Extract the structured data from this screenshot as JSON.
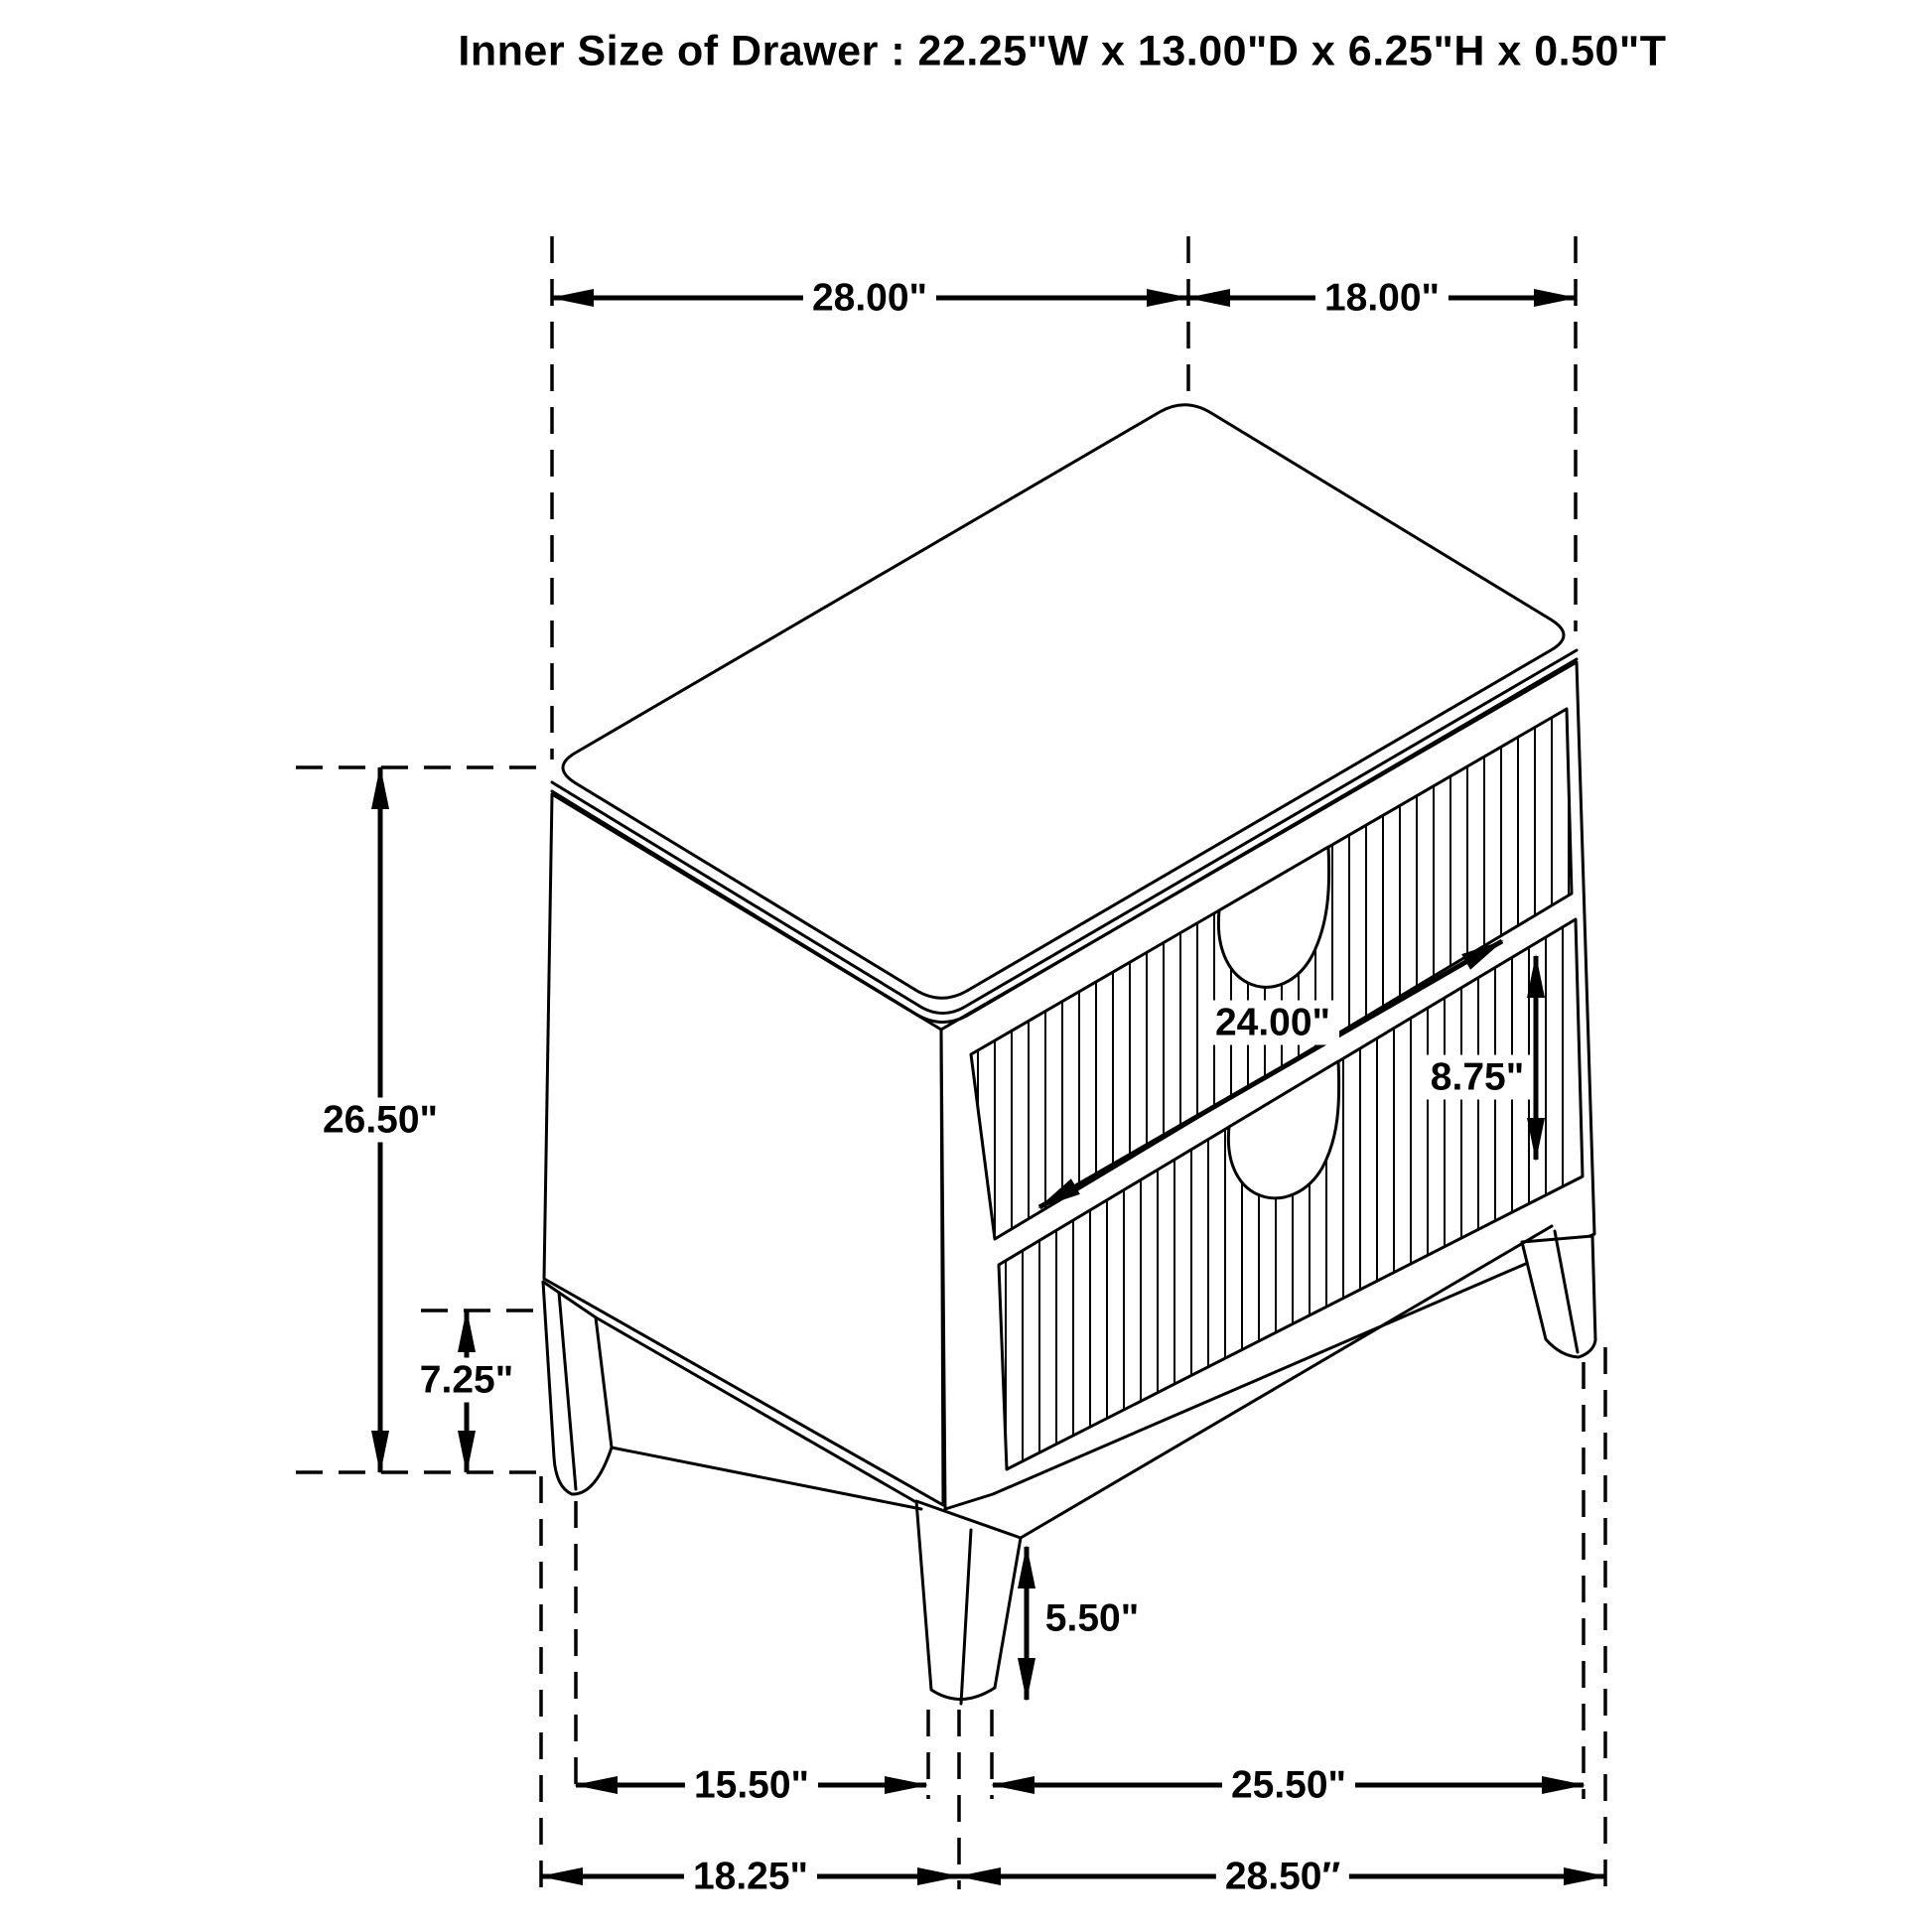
{
  "title": "Inner Size of Drawer : 22.25\"W x 13.00\"D x 6.25\"H x 0.50\"T",
  "dims": {
    "top_width": "28.00\"",
    "top_depth": "18.00\"",
    "overall_height": "26.50\"",
    "back_leg_height": "7.25\"",
    "drawer_front_width": "24.00\"",
    "drawer_front_height": "8.75\"",
    "front_leg_height": "5.50\"",
    "front_width_between_legs": "15.50\"",
    "side_depth_between_legs": "25.50\"",
    "base_overall_width": "18.25\"",
    "base_overall_depth": "28.50″"
  },
  "colors": {
    "line": "#000000",
    "background": "#ffffff"
  }
}
